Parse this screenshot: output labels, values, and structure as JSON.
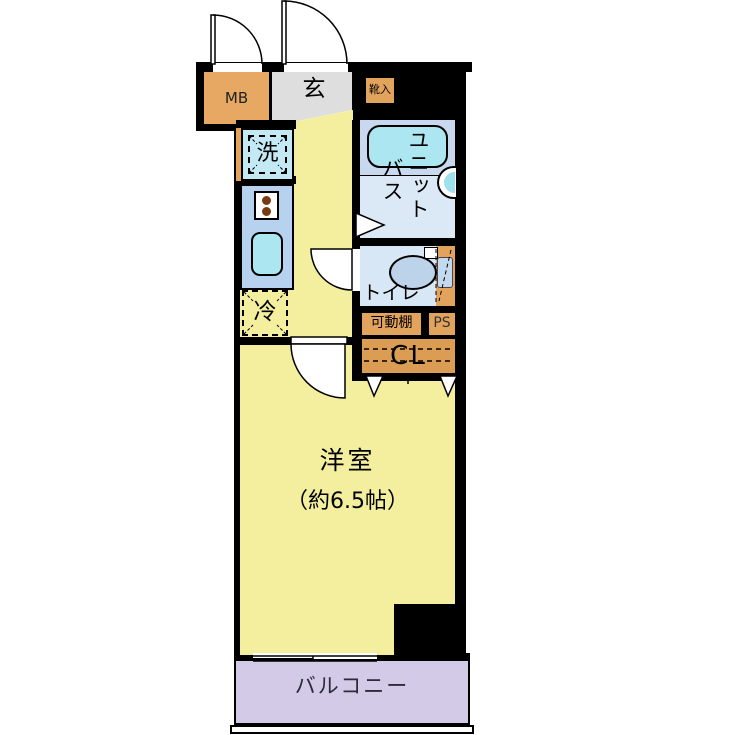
{
  "plan": {
    "meter_box": "MB",
    "entrance": "玄",
    "shoe_box": "靴入",
    "unit_bath_col_right": "ユニット",
    "unit_bath_col_left": "バス",
    "washer": "洗",
    "toilet": "トイレ",
    "movable_shelf": "可動棚",
    "pipe_space": "PS",
    "closet": "CL",
    "fridge": "冷",
    "room_name": "洋室",
    "room_size": "（約6.5帖）",
    "balcony": "バルコニー"
  },
  "colors": {
    "wall": "#000000",
    "room_yellow": "#f4ef9f",
    "entrance_gray": "#dedede",
    "storage_orange": "#e2a35c",
    "kitchen_blue": "#b7d2ee",
    "bath_blue": "#c8d8ef",
    "bath_blue_light": "#dbe8f5",
    "tub_cyan": "#ace6f0",
    "toilet_blue": "#d8e7f6",
    "balcony_purple": "#d3cae8"
  }
}
